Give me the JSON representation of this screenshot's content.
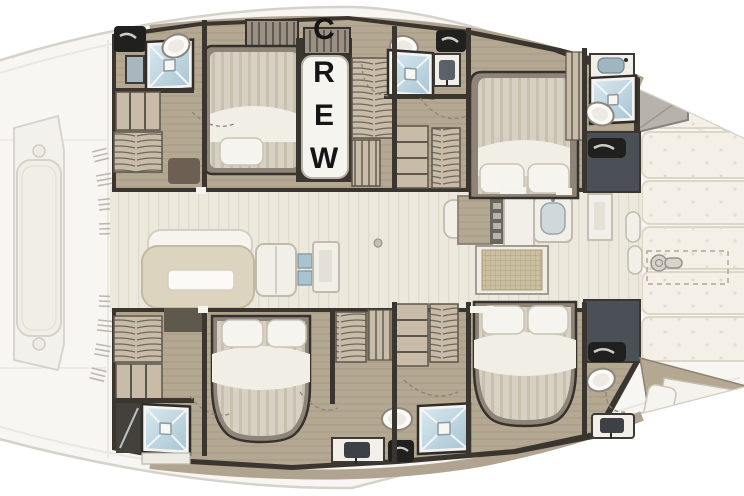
{
  "labels": {
    "crew": "CREW"
  },
  "plan": {
    "type": "catamaran-deck-plan",
    "areas": [
      "fore-deck-lounge",
      "port-hull",
      "starboard-hull",
      "saloon-galley",
      "crew-berth",
      "aft-deck"
    ],
    "fixtures": [
      "double-bed",
      "double-bed",
      "double-bed",
      "double-bed",
      "crew-berth",
      "shower",
      "shower",
      "shower",
      "shower",
      "shower",
      "toilet",
      "toilet",
      "toilet",
      "toilet",
      "toilet",
      "sink",
      "sink",
      "sink",
      "sink",
      "sofa",
      "table",
      "galley-stove",
      "fridge",
      "wardrobe",
      "tender-storage"
    ]
  },
  "colors": {
    "deck": "#f7f6f2",
    "deck_line": "#d5d2cb",
    "deck_inner": "#e9e7e1",
    "wall": "#3a362f",
    "wall_soft": "#6b6459",
    "wood": "#b5a892",
    "wood_light": "#c8bca8",
    "saloon": "#ede8dd",
    "saloon_grain": "#e0dacb",
    "dark_room": "#4b4f56",
    "locker": "#20201e",
    "locker_handle": "#cfcdc8",
    "shower_frame": "#f4f3ef",
    "shower_blue": "#aac6d4",
    "shower_blue_light": "#d7e7ee",
    "mattress": "#d7d1c4",
    "mattress_stripe": "#c7c0af",
    "pillow": "#f6f4ee",
    "pillow_line": "#c9c3b4",
    "duvet": "#f1eee6",
    "sofa_seat": "#dcd4bf",
    "sofa_back": "#f6f4ee",
    "furniture_white": "#f2efe8",
    "furniture_line": "#c0bbae",
    "grid_bg": "#cbbfa2",
    "grid_line": "#a89a76",
    "tan": "#b0a390",
    "cushion": "#f4f0e7",
    "cushion_line": "#ddd6c6",
    "tuft": "#e3dccd",
    "porcelain": "#fbfaf7",
    "porcelain_line": "#8b867c",
    "text": "#151515"
  }
}
